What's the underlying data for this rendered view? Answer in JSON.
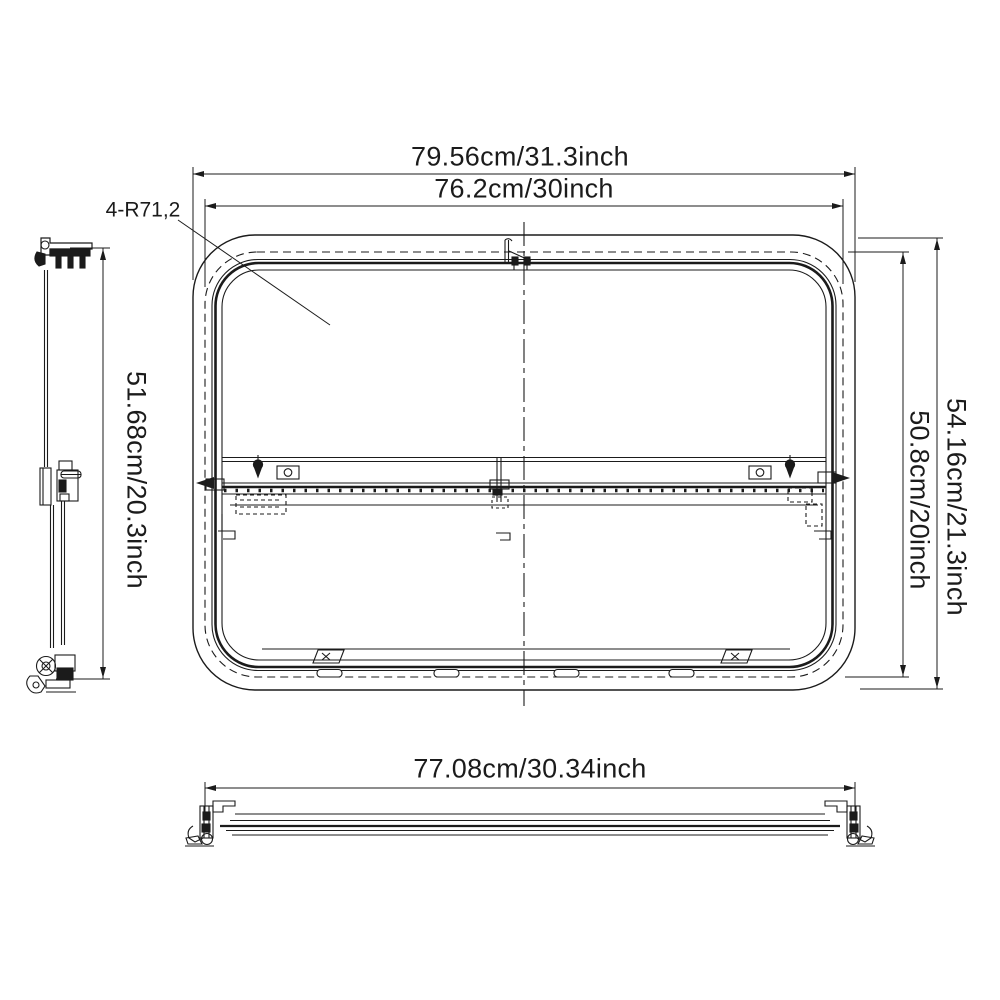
{
  "drawing": {
    "product": "rv-window-dimension-drawing",
    "dimensions": {
      "top_outer": "79.56cm/31.3inch",
      "top_inner": "76.2cm/30inch",
      "left_height": "51.68cm/20.3inch",
      "right_inner": "50.8cm/20inch",
      "right_outer": "54.16cm/21.3inch",
      "bottom_width": "77.08cm/30.34inch",
      "corner_radius_note": "4-R71,2"
    },
    "colors": {
      "line": "#1b1b1b",
      "background": "#ffffff"
    }
  }
}
